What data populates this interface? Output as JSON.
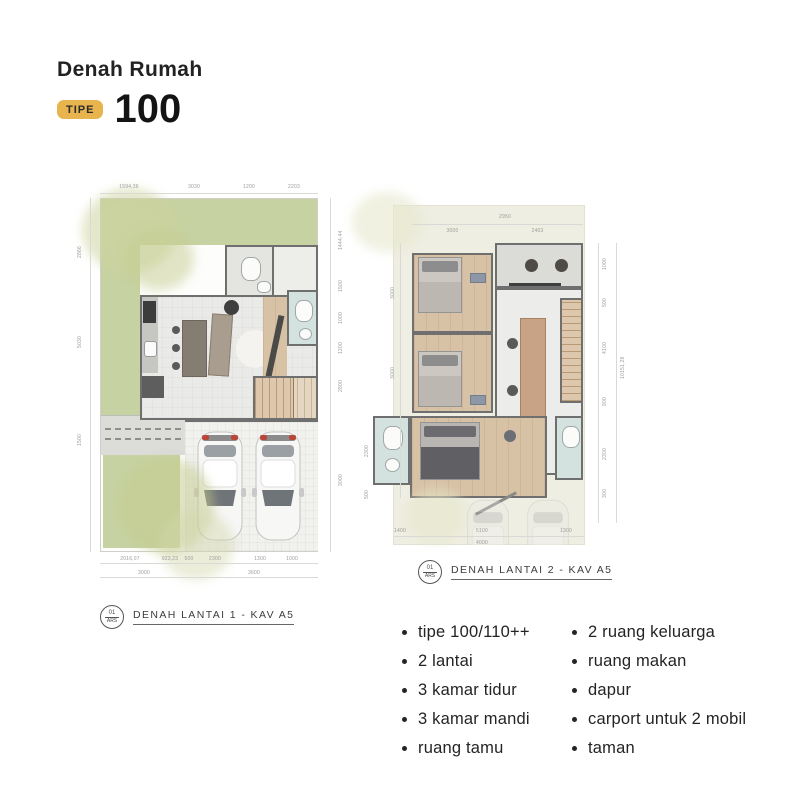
{
  "header": {
    "title": "Denah Rumah",
    "badge": "TIPE",
    "type_number": "100"
  },
  "plan1": {
    "label": "DENAH LANTAI 1 - KAV A5",
    "bubble_top": "01",
    "bubble_bottom": "ARS",
    "dims_top": [
      "1594,36",
      "3030",
      "1200",
      "2203"
    ],
    "dims_left": [
      "2866",
      "5030",
      "1500"
    ],
    "dims_right": [
      "1444,44",
      "1500",
      "1000",
      "1200",
      "2800",
      "3000"
    ],
    "dims_bottom": [
      "2016,07",
      "923,23",
      "500",
      "2300",
      "1300",
      "1000"
    ],
    "dims_bottom2": [
      "3000",
      "3600"
    ]
  },
  "plan2": {
    "label": "DENAH LANTAI 2 - KAV A5",
    "bubble_top": "01",
    "bubble_bottom": "ARS",
    "dims_top": [
      "2950"
    ],
    "dims_top2": [
      "3000",
      "2403"
    ],
    "dims_left": [
      "3000",
      "3000",
      "2300",
      "500"
    ],
    "dims_right": [
      "1000",
      "500",
      "4100",
      "900",
      "2300",
      "300"
    ],
    "dims_right_outer": "10151,28",
    "dims_bottom": [
      "1400",
      "5100",
      "1300"
    ],
    "dims_bottom2": [
      "4000"
    ]
  },
  "features": {
    "col1": [
      "tipe 100/110++",
      "2 lantai",
      "3 kamar tidur",
      "3 kamar mandi",
      "ruang tamu"
    ],
    "col2": [
      "2 ruang keluarga",
      "ruang makan",
      "dapur",
      "carport untuk 2 mobil",
      "taman"
    ]
  },
  "colors": {
    "badge_gold": "#e7b44d",
    "garden_green": "#c7d2a2",
    "wood_floor": "#d8c2a6",
    "bathroom_blue": "#d3e1df",
    "wall_gray": "#6f6f6f",
    "site_cream": "#efeee2"
  }
}
